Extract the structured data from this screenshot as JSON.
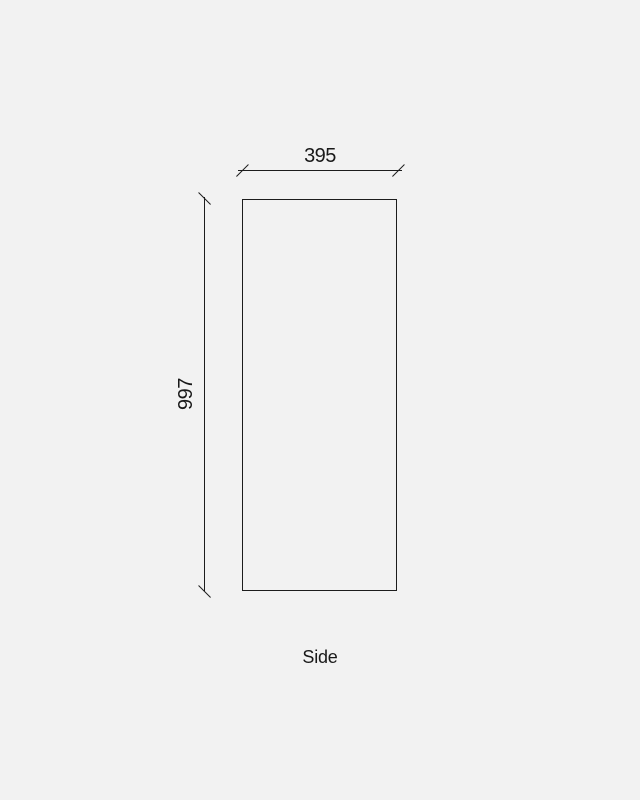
{
  "drawing": {
    "view_label": "Side",
    "dimensions": {
      "width_label": "395",
      "height_label": "997"
    },
    "colors": {
      "background": "#f2f2f2",
      "line": "#1d1d1d",
      "text": "#191919"
    }
  }
}
